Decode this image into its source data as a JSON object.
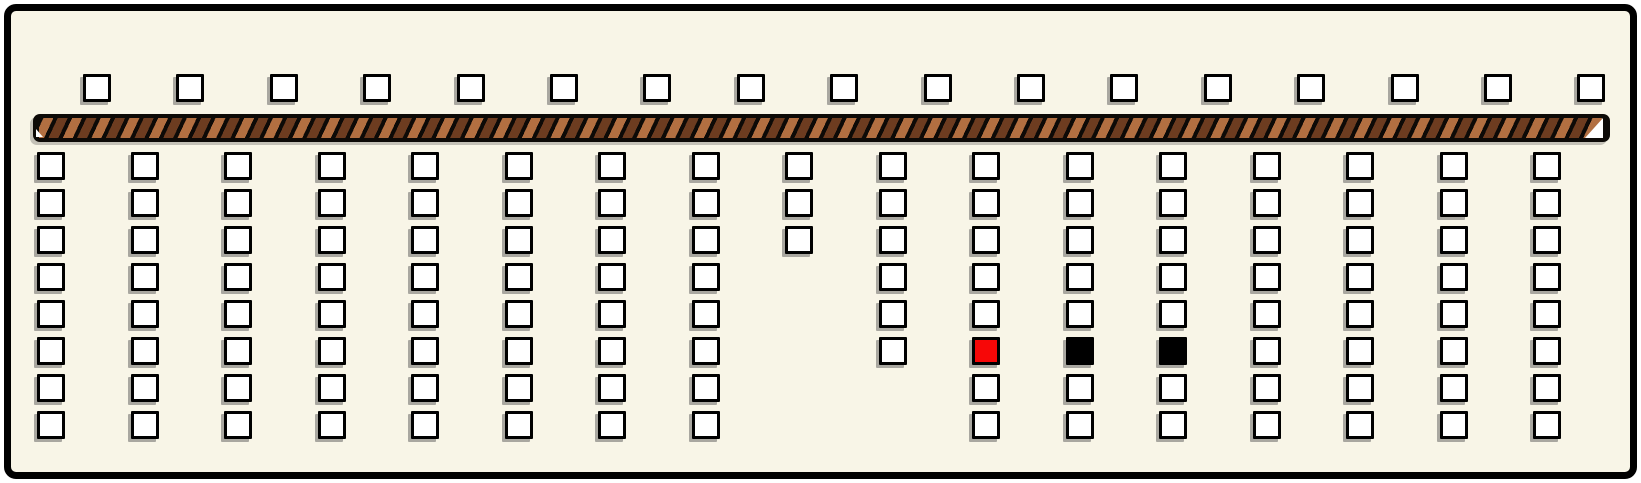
{
  "palette": {
    "page_background": "#ffffff",
    "panel_background": "#f8f5e7",
    "outline": "#000000",
    "box_fill": "#ffffff",
    "box_shadow": "rgba(90,90,90,0.5)",
    "stripe_light": "#b26f41",
    "stripe_dark": "#6d3c20",
    "stripe_base": "#0d0a07",
    "notch": "#ffffff",
    "filled_red": "#f70707",
    "filled_black": "#000000"
  },
  "top_row": {
    "count": 17,
    "start_x": 83,
    "y": 74,
    "spacing": 93.4,
    "size": 28
  },
  "divider_bar": {
    "x": 33,
    "y": 114,
    "width": 1577,
    "height": 28
  },
  "grid": {
    "start_x": 37,
    "start_y": 152,
    "col_spacing": 93.5,
    "row_spacing": 37,
    "size": 28,
    "columns": [
      {
        "rows": 8
      },
      {
        "rows": 8
      },
      {
        "rows": 8
      },
      {
        "rows": 8
      },
      {
        "rows": 8
      },
      {
        "rows": 8
      },
      {
        "rows": 8
      },
      {
        "rows": 8
      },
      {
        "rows": 3
      },
      {
        "rows": 6
      },
      {
        "rows": 8,
        "fills": {
          "6": "red"
        }
      },
      {
        "rows": 8,
        "fills": {
          "6": "black"
        }
      },
      {
        "rows": 8,
        "fills": {
          "6": "black"
        }
      },
      {
        "rows": 8
      },
      {
        "rows": 8
      },
      {
        "rows": 8
      },
      {
        "rows": 8
      }
    ]
  }
}
